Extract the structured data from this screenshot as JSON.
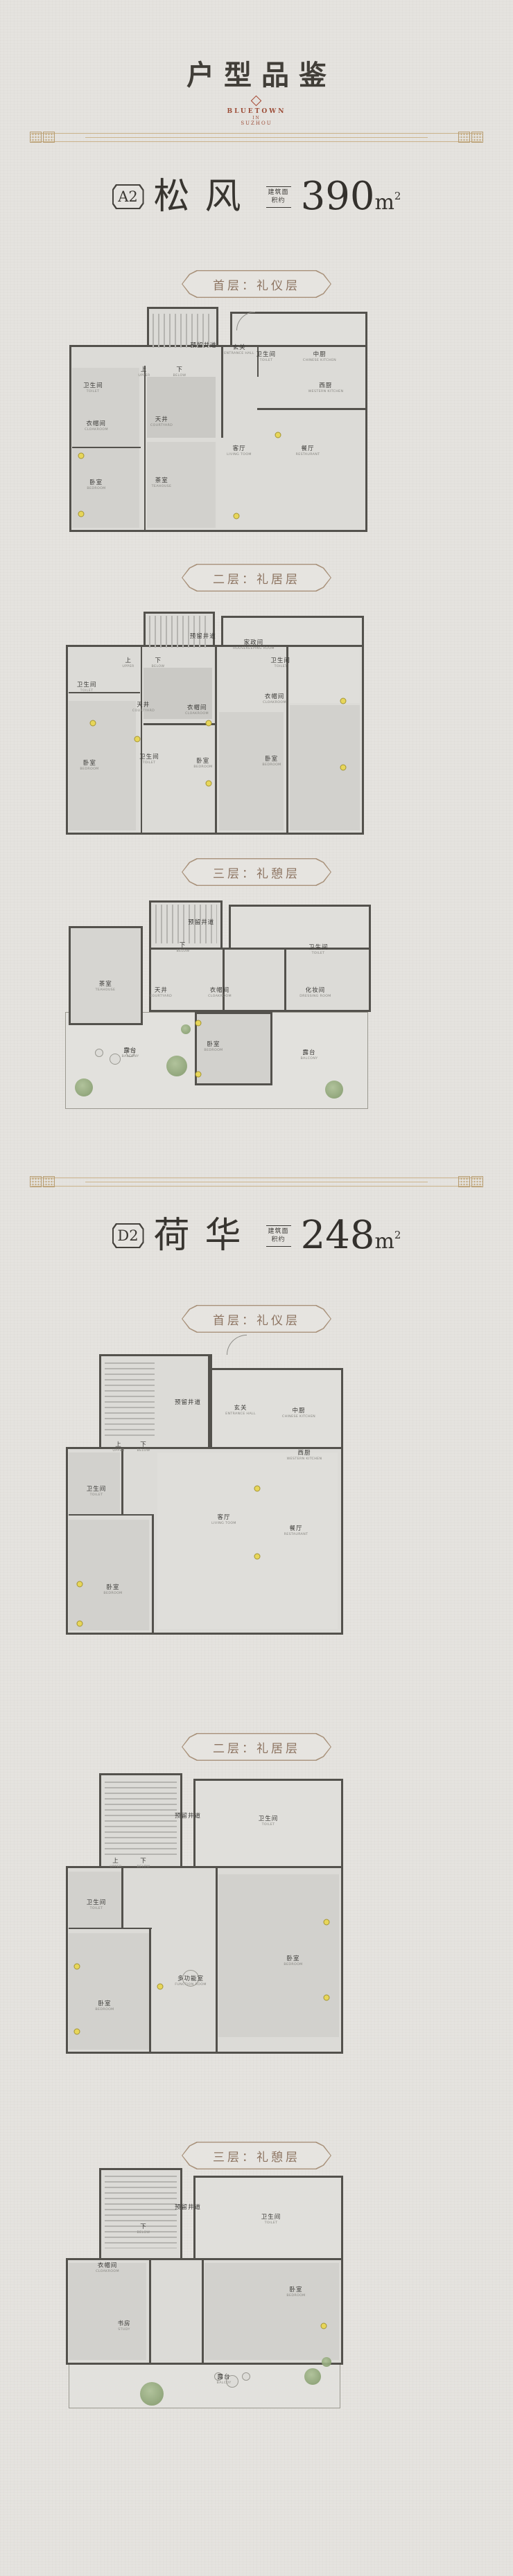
{
  "header": {
    "title": "户型品鉴",
    "brand_line1": "BLUETOWN",
    "brand_line2": "IN",
    "brand_line3": "SUZHOU",
    "accent_color": "#a5452f",
    "divider_color": "#c9b189"
  },
  "sections": [
    {
      "badge": "A2",
      "name": "松风",
      "area_note_1": "建筑面",
      "area_note_2": "积约",
      "area_value": "390",
      "area_unit": "m",
      "area_sup": "2",
      "floors": [
        {
          "label": "首层：礼仪层",
          "rooms": [
            {
              "cn": "预留井道",
              "en": "",
              "x": 45,
              "y": 17
            },
            {
              "cn": "玄关",
              "en": "ENTRANCE HALL",
              "x": 57,
              "y": 19
            },
            {
              "cn": "卫生间",
              "en": "TOILET",
              "x": 66,
              "y": 22
            },
            {
              "cn": "中厨",
              "en": "CHINESE KITCHEN",
              "x": 84,
              "y": 22
            },
            {
              "cn": "西厨",
              "en": "WESTERN KITCHEN",
              "x": 86,
              "y": 36
            },
            {
              "cn": "上",
              "en": "UPPER",
              "x": 25,
              "y": 29
            },
            {
              "cn": "下",
              "en": "BELOW",
              "x": 37,
              "y": 29
            },
            {
              "cn": "卫生间",
              "en": "TOILET",
              "x": 8,
              "y": 36
            },
            {
              "cn": "衣帽间",
              "en": "CLOAKROOM",
              "x": 9,
              "y": 53
            },
            {
              "cn": "天井",
              "en": "COURTYARD",
              "x": 31,
              "y": 51
            },
            {
              "cn": "客厅",
              "en": "LIVING TOOM",
              "x": 57,
              "y": 64
            },
            {
              "cn": "餐厅",
              "en": "RESTAURANT",
              "x": 80,
              "y": 64
            },
            {
              "cn": "卧室",
              "en": "BEDROOM",
              "x": 9,
              "y": 79
            },
            {
              "cn": "茶室",
              "en": "TEAHOUSE",
              "x": 31,
              "y": 78
            }
          ]
        },
        {
          "label": "二层：礼居层",
          "rooms": [
            {
              "cn": "预留井道",
              "en": "",
              "x": 46,
              "y": 11
            },
            {
              "cn": "家政间",
              "en": "HOUSEKEEPING ROOM",
              "x": 63,
              "y": 15
            },
            {
              "cn": "卫生间",
              "en": "TOILET",
              "x": 72,
              "y": 23
            },
            {
              "cn": "上",
              "en": "UPPER",
              "x": 21,
              "y": 23
            },
            {
              "cn": "下",
              "en": "BELOW",
              "x": 31,
              "y": 23
            },
            {
              "cn": "卫生间",
              "en": "TOILET",
              "x": 7,
              "y": 34
            },
            {
              "cn": "天井",
              "en": "COURTYARD",
              "x": 26,
              "y": 43
            },
            {
              "cn": "衣帽间",
              "en": "CLOAKROOM",
              "x": 44,
              "y": 44
            },
            {
              "cn": "衣帽间",
              "en": "CLOAKROOM",
              "x": 70,
              "y": 39
            },
            {
              "cn": "卫生间",
              "en": "TOILET",
              "x": 28,
              "y": 66
            },
            {
              "cn": "卧室",
              "en": "BEDROOM",
              "x": 8,
              "y": 69
            },
            {
              "cn": "卧室",
              "en": "BEDROOM",
              "x": 46,
              "y": 68
            },
            {
              "cn": "卧室",
              "en": "BEDROOM",
              "x": 69,
              "y": 67
            }
          ]
        },
        {
          "label": "三层：礼憩层",
          "rooms": [
            {
              "cn": "茶室",
              "en": "TEAHOUSE",
              "x": 14,
              "y": 40
            },
            {
              "cn": "预留井道",
              "en": "",
              "x": 45,
              "y": 10
            },
            {
              "cn": "下",
              "en": "BELOW",
              "x": 39,
              "y": 22
            },
            {
              "cn": "卫生间",
              "en": "TOILET",
              "x": 83,
              "y": 23
            },
            {
              "cn": "天井",
              "en": "COURTYARD",
              "x": 32,
              "y": 43
            },
            {
              "cn": "衣帽间",
              "en": "CLOAKROOM",
              "x": 51,
              "y": 43
            },
            {
              "cn": "化妆间",
              "en": "DRESSING ROOM",
              "x": 82,
              "y": 43
            },
            {
              "cn": "卧室",
              "en": "BEDROOM",
              "x": 49,
              "y": 68
            },
            {
              "cn": "露台",
              "en": "BALCONY",
              "x": 22,
              "y": 71
            },
            {
              "cn": "露台",
              "en": "BALCONY",
              "x": 80,
              "y": 72
            }
          ]
        }
      ]
    },
    {
      "badge": "D2",
      "name": "荷华",
      "area_note_1": "建筑面",
      "area_note_2": "积约",
      "area_value": "248",
      "area_unit": "m",
      "area_sup": "2",
      "floors": [
        {
          "label": "首层：礼仪层",
          "rooms": [
            {
              "cn": "预留井道",
              "en": "",
              "x": 44,
              "y": 17
            },
            {
              "cn": "玄关",
              "en": "ENTRANCE HALL",
              "x": 63,
              "y": 20
            },
            {
              "cn": "中厨",
              "en": "CHINESE KITCHEN",
              "x": 84,
              "y": 21
            },
            {
              "cn": "上",
              "en": "UPPER",
              "x": 19,
              "y": 33
            },
            {
              "cn": "下",
              "en": "BELOW",
              "x": 28,
              "y": 33
            },
            {
              "cn": "西厨",
              "en": "WESTERN KITCHEN",
              "x": 86,
              "y": 36
            },
            {
              "cn": "卫生间",
              "en": "TOILET",
              "x": 11,
              "y": 49
            },
            {
              "cn": "客厅",
              "en": "LIVING TOOM",
              "x": 57,
              "y": 59
            },
            {
              "cn": "餐厅",
              "en": "RESTAURANT",
              "x": 83,
              "y": 63
            },
            {
              "cn": "卧室",
              "en": "BEDROOM",
              "x": 17,
              "y": 84
            }
          ]
        },
        {
          "label": "二层：礼居层",
          "rooms": [
            {
              "cn": "预留井道",
              "en": "",
              "x": 44,
              "y": 15
            },
            {
              "cn": "卫生间",
              "en": "TOILET",
              "x": 73,
              "y": 17
            },
            {
              "cn": "上",
              "en": "UPPER",
              "x": 18,
              "y": 32
            },
            {
              "cn": "下",
              "en": "BELOW",
              "x": 28,
              "y": 32
            },
            {
              "cn": "卫生间",
              "en": "TOILET",
              "x": 11,
              "y": 47
            },
            {
              "cn": "多功能室",
              "en": "FUNCTION ROOM",
              "x": 45,
              "y": 74
            },
            {
              "cn": "卧室",
              "en": "BEDROOM",
              "x": 82,
              "y": 67
            },
            {
              "cn": "卧室",
              "en": "BEDROOM",
              "x": 14,
              "y": 83
            }
          ]
        },
        {
          "label": "三层：礼憩层",
          "rooms": [
            {
              "cn": "预留井道",
              "en": "",
              "x": 44,
              "y": 16
            },
            {
              "cn": "下",
              "en": "BELOW",
              "x": 28,
              "y": 25
            },
            {
              "cn": "卫生间",
              "en": "TOILET",
              "x": 74,
              "y": 21
            },
            {
              "cn": "衣帽间",
              "en": "CLOAKROOM",
              "x": 15,
              "y": 41
            },
            {
              "cn": "书房",
              "en": "STUDY",
              "x": 21,
              "y": 65
            },
            {
              "cn": "卧室",
              "en": "BEDROOM",
              "x": 83,
              "y": 51
            },
            {
              "cn": "露台",
              "en": "BALCOY",
              "x": 57,
              "y": 87
            }
          ]
        }
      ]
    }
  ]
}
